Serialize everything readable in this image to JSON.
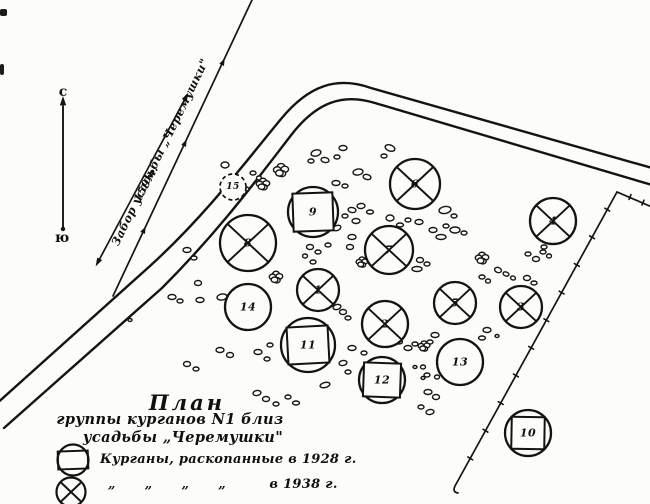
{
  "page": {
    "paper_color": "#fcfcf9",
    "ink_color": "#141414"
  },
  "compass": {
    "north": "с",
    "south": "ю"
  },
  "annotations": {
    "fence_line_label": "Забор усадьбы „Черемушки\"",
    "fence_distance_label": "159м."
  },
  "title": {
    "line1": "План",
    "line2": "группы курганов N1 близ",
    "line3": "усадьбы „Черемушки\""
  },
  "legend": {
    "items": [
      {
        "symbol": "circle-with-square",
        "label": "Курганы, раскопанные в 1928 г."
      },
      {
        "symbol": "circle-with-x",
        "label": "„      „      „      „         в 1938 г."
      }
    ]
  },
  "kurgans": [
    {
      "id": "1",
      "type": "x",
      "x": 318,
      "y": 290,
      "r": 21
    },
    {
      "id": "2",
      "type": "x",
      "x": 385,
      "y": 324,
      "r": 23
    },
    {
      "id": "3",
      "type": "x",
      "x": 521,
      "y": 307,
      "r": 21
    },
    {
      "id": "4",
      "type": "x",
      "x": 553,
      "y": 221,
      "r": 23
    },
    {
      "id": "5",
      "type": "x",
      "x": 455,
      "y": 303,
      "r": 21
    },
    {
      "id": "6",
      "type": "x",
      "x": 415,
      "y": 184,
      "r": 25
    },
    {
      "id": "7",
      "type": "x",
      "x": 389,
      "y": 250,
      "r": 24
    },
    {
      "id": "8",
      "type": "x",
      "x": 248,
      "y": 243,
      "r": 28
    },
    {
      "id": "9",
      "type": "square",
      "x": 313,
      "y": 212,
      "r": 25,
      "sq": [
        40,
        38,
        -2
      ]
    },
    {
      "id": "10",
      "type": "square",
      "x": 528,
      "y": 433,
      "r": 23,
      "sq": [
        33,
        32,
        1
      ]
    },
    {
      "id": "11",
      "type": "square",
      "x": 308,
      "y": 345,
      "r": 27,
      "sq": [
        41,
        37,
        -3
      ]
    },
    {
      "id": "12",
      "type": "square",
      "x": 382,
      "y": 380,
      "r": 23,
      "sq": [
        37,
        34,
        2
      ]
    },
    {
      "id": "13",
      "type": "plain",
      "x": 460,
      "y": 362,
      "r": 23
    },
    {
      "id": "14",
      "type": "plain",
      "x": 248,
      "y": 307,
      "r": 23
    },
    {
      "id": "15",
      "type": "dashed",
      "x": 233,
      "y": 187,
      "r": 13
    }
  ],
  "stones": [
    [
      316,
      153,
      5,
      3,
      -15
    ],
    [
      311,
      161,
      3,
      2,
      0
    ],
    [
      325,
      160,
      4,
      2.5,
      10
    ],
    [
      343,
      148,
      4,
      2.5,
      0
    ],
    [
      337,
      157,
      3,
      2,
      0
    ],
    [
      390,
      148,
      5,
      3,
      20
    ],
    [
      384,
      156,
      3,
      2,
      0
    ],
    [
      358,
      172,
      5,
      3,
      -10
    ],
    [
      367,
      177,
      4,
      2.5,
      15
    ],
    [
      336,
      183,
      4,
      2.5,
      0
    ],
    [
      345,
      186,
      3,
      2,
      0
    ],
    [
      333,
      203,
      3.5,
      2.5,
      0
    ],
    [
      352,
      210,
      4,
      2.5,
      10
    ],
    [
      361,
      206,
      4,
      2.5,
      -5
    ],
    [
      370,
      212,
      3.5,
      2,
      0
    ],
    [
      345,
      216,
      3,
      2,
      0
    ],
    [
      356,
      221,
      4,
      2.5,
      0
    ],
    [
      337,
      228,
      4,
      2.5,
      -20
    ],
    [
      352,
      237,
      4,
      2.5,
      0
    ],
    [
      390,
      218,
      4,
      3,
      0
    ],
    [
      400,
      225,
      3.5,
      2,
      0
    ],
    [
      408,
      220,
      3,
      2,
      0
    ],
    [
      419,
      222,
      4,
      2.5,
      0
    ],
    [
      445,
      210,
      6,
      3.5,
      -10
    ],
    [
      454,
      216,
      3,
      2,
      0
    ],
    [
      433,
      230,
      4,
      2.5,
      0
    ],
    [
      446,
      226,
      3,
      2,
      0
    ],
    [
      455,
      230,
      5,
      3,
      0
    ],
    [
      464,
      233,
      3,
      2,
      0
    ],
    [
      441,
      237,
      5,
      2.5,
      0
    ],
    [
      225,
      165,
      4,
      3,
      0
    ],
    [
      253,
      173,
      3,
      2,
      0
    ],
    [
      259,
      178,
      2.5,
      2,
      0
    ],
    [
      246,
      189,
      3,
      2,
      0
    ],
    [
      187,
      250,
      4,
      2.5,
      0
    ],
    [
      194,
      258,
      3,
      2,
      0
    ],
    [
      198,
      283,
      3.5,
      2.5,
      0
    ],
    [
      172,
      297,
      4,
      2.5,
      0
    ],
    [
      180,
      301,
      3,
      2,
      0
    ],
    [
      222,
      297,
      5,
      3,
      -10
    ],
    [
      130,
      320,
      2,
      1.5,
      0
    ],
    [
      310,
      247,
      3.5,
      2.5,
      0
    ],
    [
      318,
      252,
      3,
      2,
      0
    ],
    [
      305,
      256,
      2.5,
      2,
      0
    ],
    [
      328,
      245,
      3,
      2,
      0
    ],
    [
      313,
      262,
      3,
      2,
      0
    ],
    [
      350,
      247,
      3.5,
      2.5,
      0
    ],
    [
      420,
      260,
      3.5,
      2.5,
      0
    ],
    [
      427,
      264,
      3,
      2,
      0
    ],
    [
      417,
      269,
      5,
      2.5,
      0
    ],
    [
      482,
      277,
      3,
      2,
      0
    ],
    [
      488,
      281,
      2.5,
      2,
      0
    ],
    [
      498,
      270,
      3.5,
      2.5,
      20
    ],
    [
      506,
      274,
      3,
      2,
      20
    ],
    [
      513,
      278,
      2.5,
      2,
      20
    ],
    [
      528,
      254,
      3,
      2,
      0
    ],
    [
      536,
      259,
      3.5,
      2.5,
      0
    ],
    [
      543,
      252,
      3,
      2,
      0
    ],
    [
      527,
      278,
      3.5,
      2.5,
      0
    ],
    [
      534,
      283,
      3,
      2,
      0
    ],
    [
      549,
      256,
      2.5,
      2,
      0
    ],
    [
      544,
      247,
      3,
      2,
      0
    ],
    [
      467,
      295,
      3,
      2,
      0
    ],
    [
      473,
      299,
      2.5,
      2,
      0
    ],
    [
      435,
      335,
      4,
      2.5,
      0
    ],
    [
      430,
      342,
      3,
      2,
      0
    ],
    [
      487,
      330,
      4,
      2.5,
      0
    ],
    [
      482,
      338,
      3.5,
      2,
      0
    ],
    [
      497,
      336,
      2,
      1.5,
      0
    ],
    [
      423,
      367,
      2.5,
      2,
      0
    ],
    [
      427,
      375,
      3,
      2,
      0
    ],
    [
      437,
      377,
      2.5,
      2,
      0
    ],
    [
      337,
      307,
      4,
      2.5,
      -15
    ],
    [
      343,
      312,
      3.5,
      2.5,
      0
    ],
    [
      348,
      318,
      3,
      2,
      0
    ],
    [
      352,
      348,
      4,
      2.5,
      0
    ],
    [
      364,
      353,
      3,
      2,
      0
    ],
    [
      343,
      363,
      4,
      2.5,
      -10
    ],
    [
      348,
      372,
      3,
      2,
      0
    ],
    [
      325,
      385,
      5,
      2.5,
      -15
    ],
    [
      297,
      358,
      2,
      1.5,
      0
    ],
    [
      408,
      348,
      4,
      2.5,
      0
    ],
    [
      415,
      344,
      3,
      2,
      0
    ],
    [
      399,
      342,
      3.5,
      2,
      0
    ],
    [
      415,
      367,
      2,
      1.5,
      0
    ],
    [
      423,
      378,
      2,
      1.5,
      0
    ],
    [
      200,
      300,
      4,
      2.5,
      0
    ],
    [
      220,
      350,
      4,
      2.5,
      0
    ],
    [
      230,
      355,
      3.5,
      2.5,
      0
    ],
    [
      258,
      352,
      4,
      2.5,
      0
    ],
    [
      267,
      359,
      3,
      2,
      0
    ],
    [
      187,
      364,
      3.5,
      2.5,
      0
    ],
    [
      196,
      369,
      3,
      2,
      0
    ],
    [
      270,
      345,
      3,
      2,
      0
    ],
    [
      257,
      393,
      4,
      2.5,
      -10
    ],
    [
      266,
      399,
      3.5,
      2.5,
      0
    ],
    [
      276,
      404,
      3,
      2,
      0
    ],
    [
      288,
      397,
      3,
      2,
      0
    ],
    [
      296,
      403,
      3.5,
      2,
      0
    ],
    [
      428,
      392,
      4,
      2.5,
      0
    ],
    [
      436,
      397,
      3.5,
      2.5,
      0
    ],
    [
      421,
      407,
      3,
      2,
      0
    ],
    [
      430,
      412,
      4,
      2.5,
      -10
    ]
  ],
  "blobs": [
    [
      281,
      170,
      9
    ],
    [
      263,
      184,
      8
    ],
    [
      276,
      277,
      8
    ],
    [
      482,
      258,
      8
    ],
    [
      424,
      346,
      7
    ],
    [
      362,
      262,
      7
    ]
  ]
}
